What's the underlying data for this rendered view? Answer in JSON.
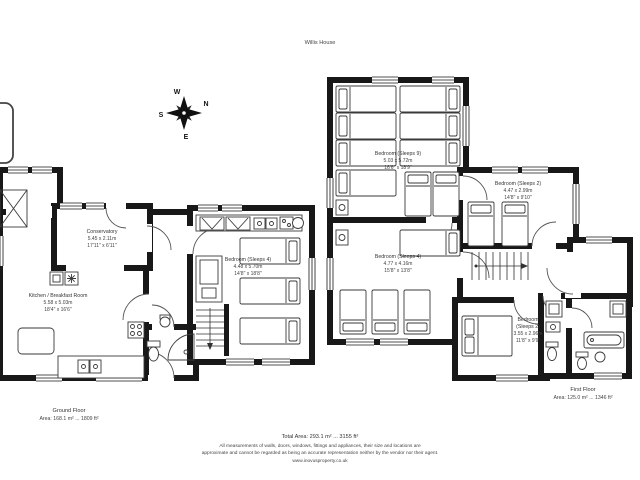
{
  "title": "Willis House",
  "compass": {
    "n": "N",
    "e": "E",
    "s": "S",
    "w": "W"
  },
  "ground_floor": {
    "label": "Ground Floor",
    "area_line": "Area: 168.1 m² ... 1809 ft²",
    "rooms": {
      "conservatory": {
        "name": "Conservatory",
        "metric": "5.45 x 2.11m",
        "imperial": "17'11\" x 6'11\""
      },
      "kitchen": {
        "name": "Kitchen / Breakfast Room",
        "metric": "5.58 x 5.03m",
        "imperial": "18'4\" x 16'6\""
      },
      "bedroom4": {
        "name": "Bedroom (Sleeps 4)",
        "metric": "4.48 x 5.70m",
        "imperial": "14'8\" x 18'8\""
      }
    }
  },
  "first_floor": {
    "label": "First Floor",
    "area_line": "Area: 125.0 m² ... 1346 ft²",
    "rooms": {
      "bedroom9": {
        "name": "Bedroom (Sleeps 9)",
        "metric": "5.03 x 5.72m",
        "imperial": "16'6\" x 18'9\""
      },
      "bedroom2a": {
        "name": "Bedroom (Sleeps 2)",
        "metric": "4.47 x 2.99m",
        "imperial": "14'8\" x 9'10\""
      },
      "bedroom4": {
        "name": "Bedroom (Sleeps 4)",
        "metric": "4.77 x 4.16m",
        "imperial": "15'8\" x 13'8\""
      },
      "bedroom2b": {
        "name": "Bedroom",
        "name2": "(Sleeps 2)",
        "metric": "3.55 x 2.96m",
        "imperial": "11'8\" x 9'9\""
      }
    }
  },
  "footer": {
    "total_area": "Total Area: 293.1 m² ... 3155 ft²",
    "disclaimer_line1": "All measurements of walls, doors, windows, fittings and appliances, their size and locations are",
    "disclaimer_line2": "approximate and cannot be regarded as being an accurate representation neither by the vendor nor their agent.",
    "website": "www.inovusproperty.co.uk"
  }
}
